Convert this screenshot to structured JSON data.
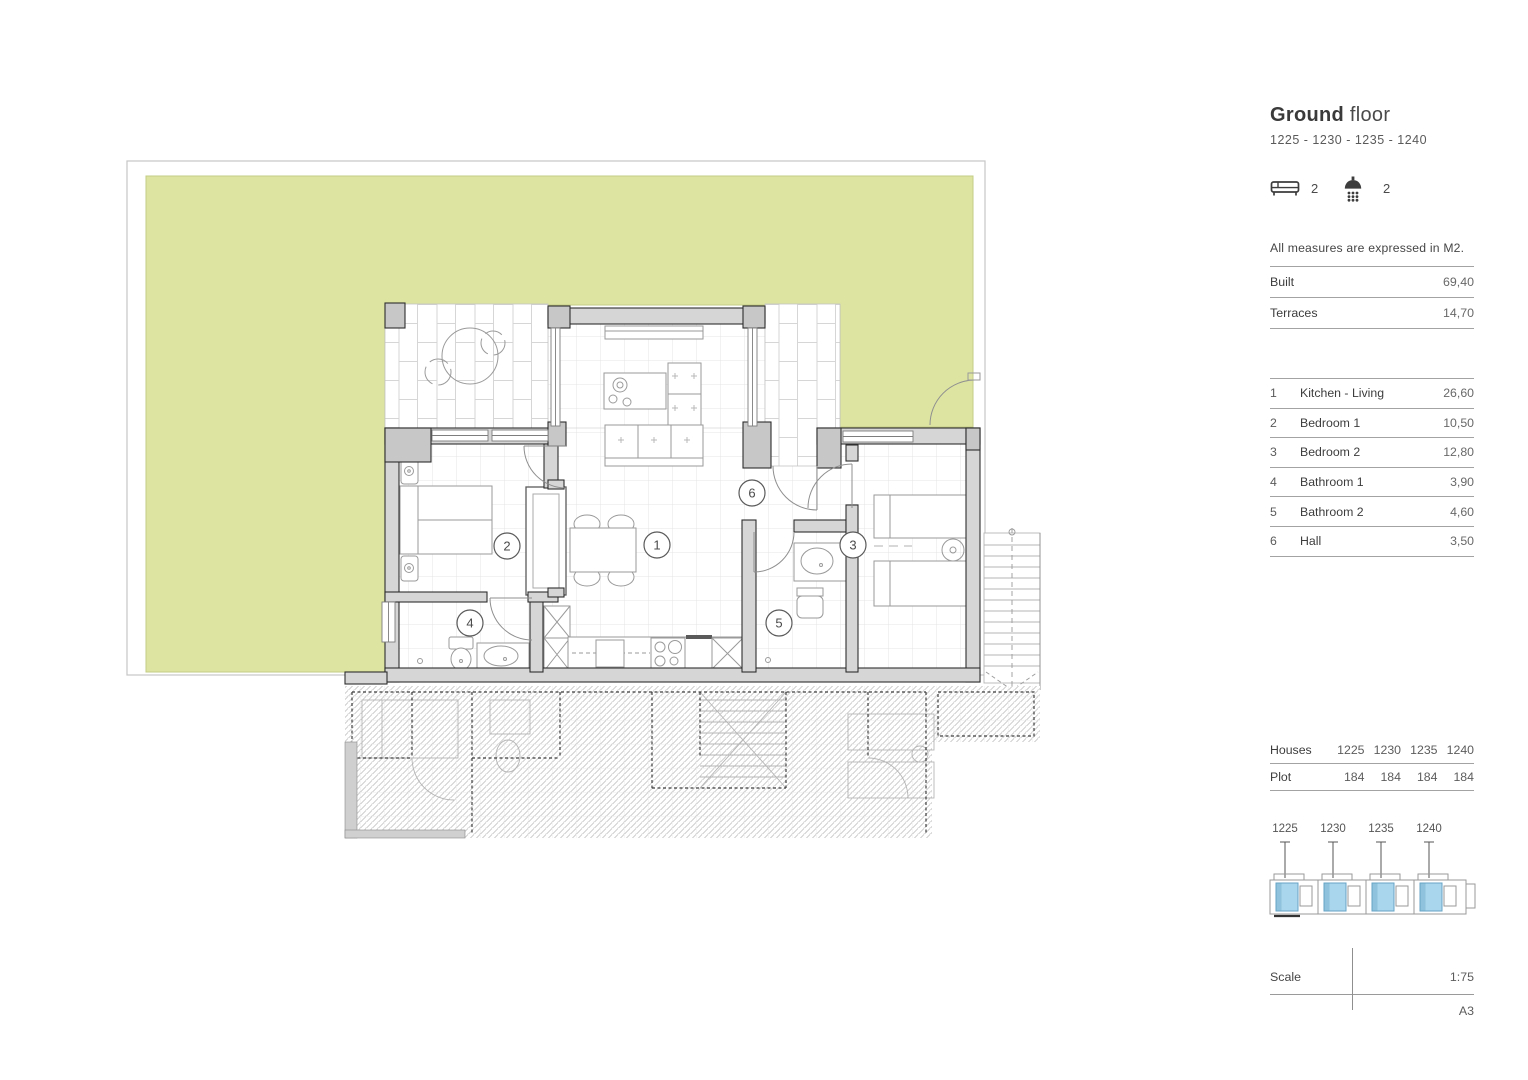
{
  "colors": {
    "terrace_green": "#dde4a2",
    "unit_highlight": "#a9d6ec"
  },
  "header": {
    "title_bold": "Ground",
    "title_light": "floor",
    "units": "1225 - 1230 - 1235 - 1240"
  },
  "features": {
    "bedrooms": "2",
    "bathrooms": "2"
  },
  "note": "All measures are expressed in M2.",
  "summary": {
    "rows": [
      {
        "label": "Built",
        "value": "69,40"
      },
      {
        "label": "Terraces",
        "value": "14,70"
      }
    ]
  },
  "rooms": [
    {
      "num": "1",
      "name": "Kitchen - Living",
      "area": "26,60"
    },
    {
      "num": "2",
      "name": "Bedroom 1",
      "area": "10,50"
    },
    {
      "num": "3",
      "name": "Bedroom 2",
      "area": "12,80"
    },
    {
      "num": "4",
      "name": "Bathroom 1",
      "area": "3,90"
    },
    {
      "num": "5",
      "name": "Bathroom 2",
      "area": "4,60"
    },
    {
      "num": "6",
      "name": "Hall",
      "area": "3,50"
    }
  ],
  "houses": {
    "label": "Houses",
    "plot_label": "Plot",
    "numbers": [
      "1225",
      "1230",
      "1235",
      "1240"
    ],
    "plots": [
      "184",
      "184",
      "184",
      "184"
    ]
  },
  "site": {
    "labels": [
      "1225",
      "1230",
      "1235",
      "1240"
    ]
  },
  "scale": {
    "label": "Scale",
    "value": "1:75",
    "sheet": "A3"
  },
  "plan": {
    "markers": [
      "1",
      "2",
      "3",
      "4",
      "5",
      "6"
    ]
  }
}
